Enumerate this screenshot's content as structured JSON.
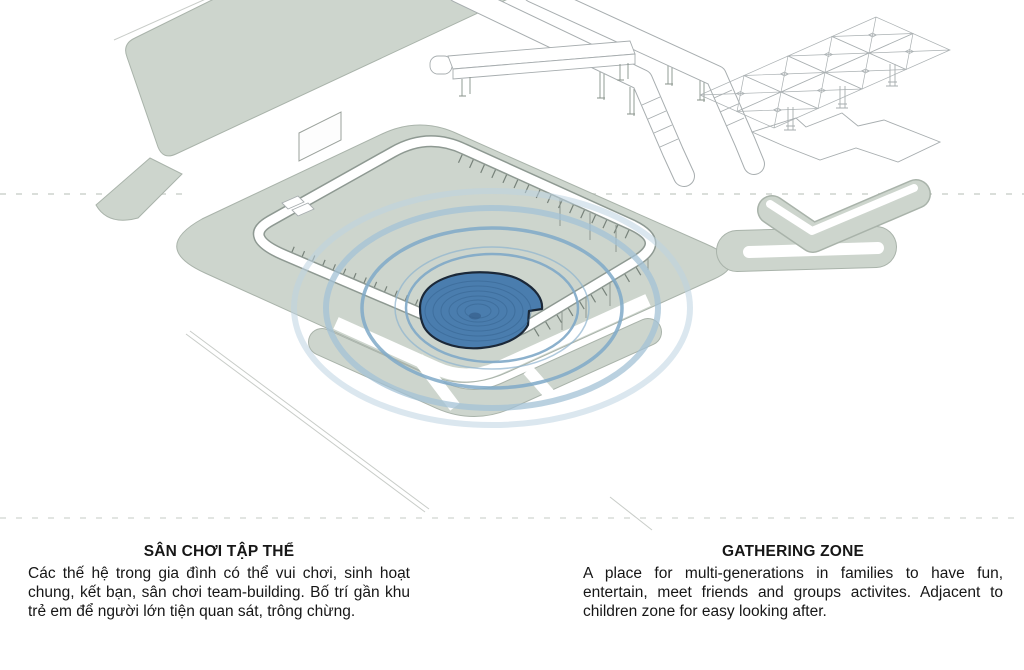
{
  "colors": {
    "highlight_blue": "#4a7dae",
    "highlight_outline": "#1b2838",
    "ground_green": "#cdd5cd",
    "ripple_blue": "#7fa9c8",
    "ripple_soft": "#a3c1d6",
    "ripple_faint": "#bed4e2",
    "line_gray": "#a7adaf"
  },
  "captions": {
    "vi": {
      "title": "SÂN CHƠI TẬP THỂ",
      "body": "Các thế hệ trong gia đình có thể vui chơi, sinh hoạt chung, kết bạn, sân chơi team-building. Bố trí gần khu trẻ em để người lớn tiện quan sát, trông chừng."
    },
    "en": {
      "title": "GATHERING ZONE",
      "body": "A place for multi-generations in families to have fun, entertain, meet friends and groups activites. Adjacent to children zone for easy looking after."
    }
  }
}
